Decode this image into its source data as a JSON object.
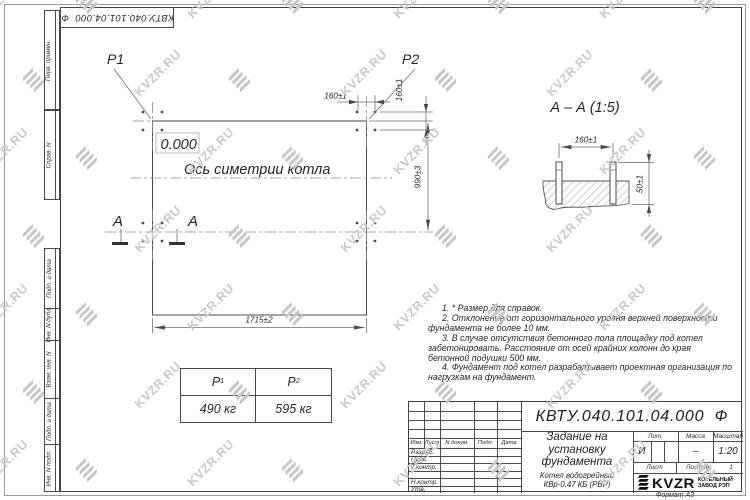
{
  "colors": {
    "line": "#4a4a4a",
    "text": "#262626",
    "watermark": "#c8c8c8"
  },
  "watermark": {
    "text": "KVZR.RU"
  },
  "margin": {
    "top_code": "КВТУ.040.101.04.000  Ф",
    "fields": [
      "Перв. примен.",
      "Справ. N",
      "Подп. и дата",
      "Инв. N дубл.",
      "Взам. инв. N",
      "Подп. и дата",
      "Инв. N подл."
    ]
  },
  "plan": {
    "p1": "P1",
    "p2": "P2",
    "elevation": "0.000",
    "axis_label": "Ось симетрии котла",
    "dim_width": "1715±2",
    "dim_height": "990±3",
    "dim_bolt_top": "160±1",
    "dim_bolt_side": "160±1",
    "section_letter": "А"
  },
  "section": {
    "title": "А – А (1:5)",
    "dim_spacing": "160±1",
    "dim_height": "50±1"
  },
  "load_table": {
    "p1": {
      "base": "P",
      "sub": "1"
    },
    "p2": {
      "base": "P",
      "sub": "2"
    },
    "values": [
      "490 кг",
      "595 кг"
    ]
  },
  "notes": [
    "1. * Размер для справок.",
    "2. Отклонение от горизонтального уровня верхней поверхности фундамента не более 10 мм.",
    "3. В случае отсутствия бетонного пола площадку под котел забетонировать. Расстояние от осей крайних колонн до края бетонной подушки 500 мм.",
    "4. Фундамент под котел разрабатывает проектная организация по нагрузкам на фундамент."
  ],
  "title_block": {
    "doc_number": "КВТУ.040.101.04.000  Ф",
    "title": "Задание на установку фундамента",
    "product": "Котел водогрейный КВр-0,47 КБ (РВР)",
    "col_izm": "Изм.",
    "col_list": "Лист",
    "col_doc": "N докум.",
    "col_podp": "Подп.",
    "col_data": "Дата",
    "rows": [
      "Разраб.",
      "Пров.",
      "Т.контр.",
      "",
      "Н.контр.",
      "Утв."
    ],
    "lit_label": "Лит.",
    "lit_value": "И",
    "mass_label": "Масса",
    "mass_value": "–",
    "scale_label": "Масштаб",
    "scale_value": "1:20",
    "sheet_label": "Лист",
    "sheets_label": "Листов",
    "sheets_value": "1",
    "logo_text": "KVZR",
    "factory": "КОТЕЛЬНЫЙ ЗАВОД РЭП",
    "format_label": "Формат А3"
  }
}
